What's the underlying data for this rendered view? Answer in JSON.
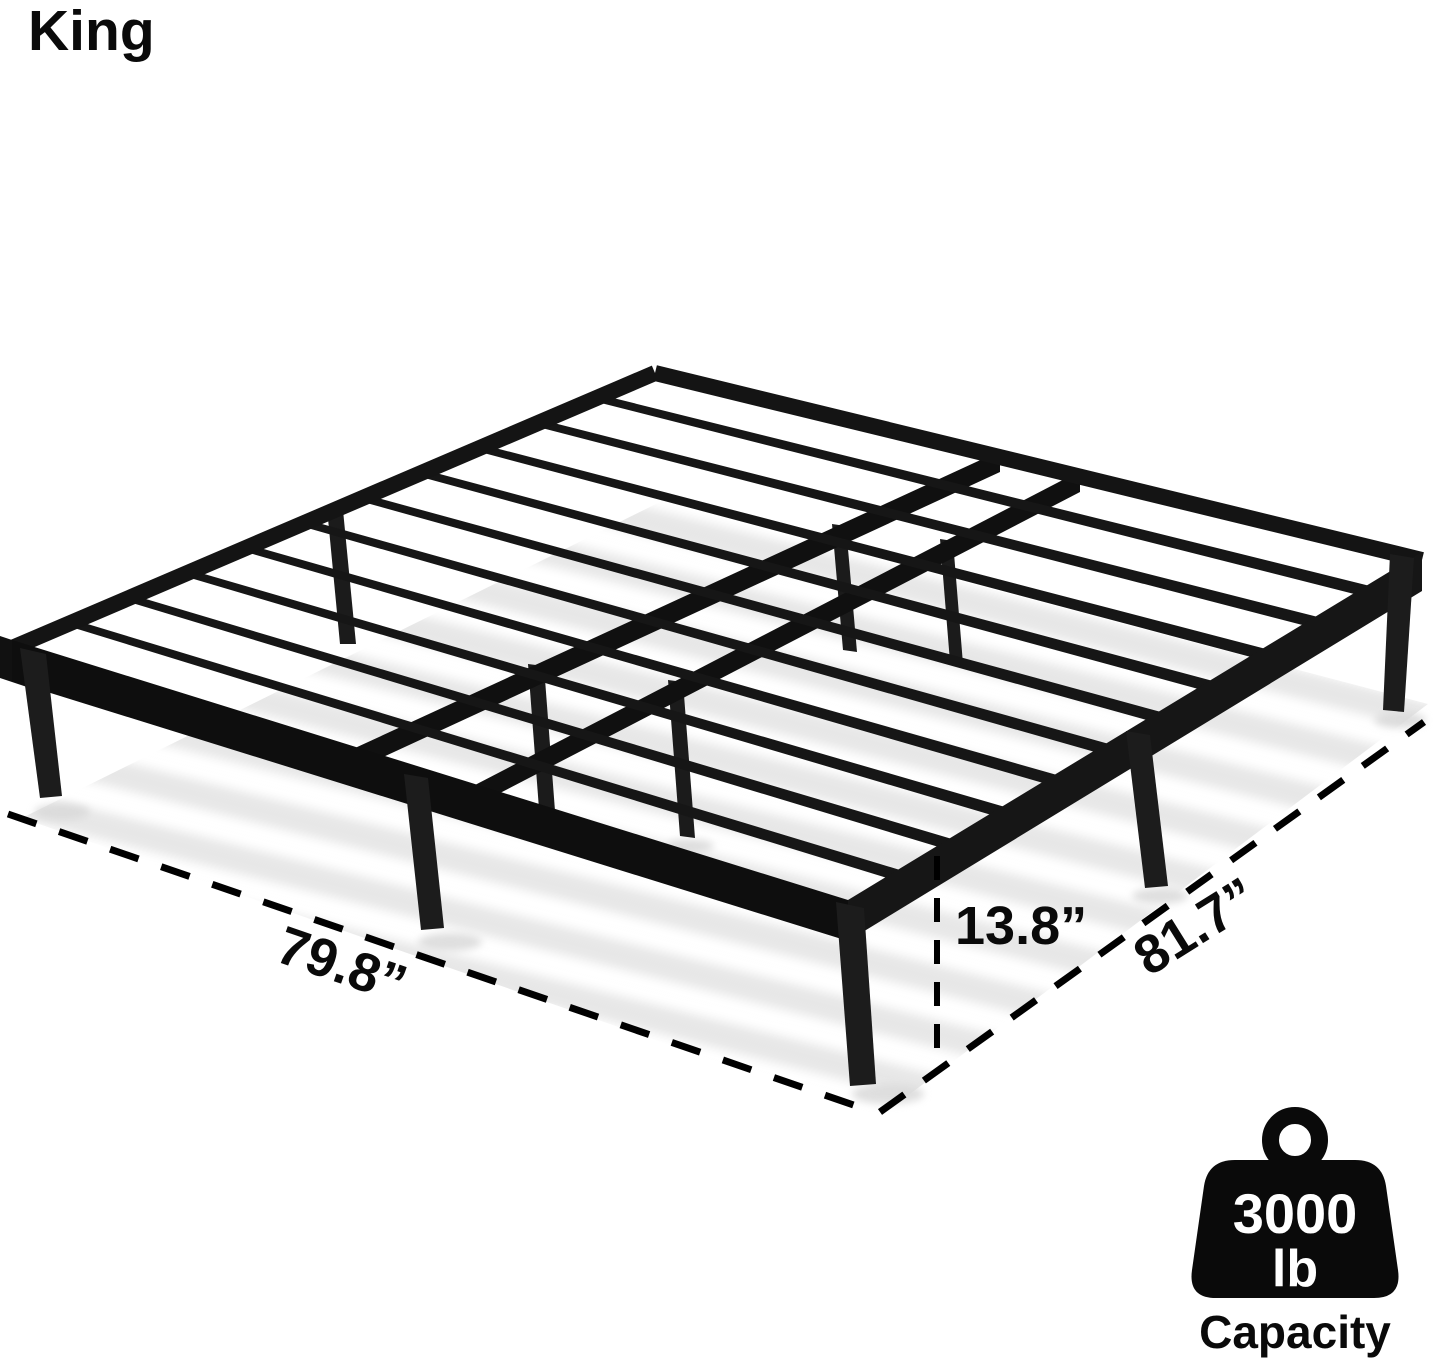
{
  "header": {
    "title": "King"
  },
  "dimensions": {
    "width_label": "79.8”",
    "height_label": "13.8”",
    "length_label": "81.7”"
  },
  "capacity_badge": {
    "icon": "weight-icon",
    "value": "3000",
    "unit": "lb",
    "caption": "Capacity"
  },
  "illustration": {
    "subject": "black metal platform bed frame with steel slats, perspective view",
    "slat_count": 10,
    "center_rail_count": 2,
    "frame_color": "#141414",
    "shadow_color": "#e7e7e7",
    "annotation_color": "#000000",
    "background": "#ffffff"
  }
}
